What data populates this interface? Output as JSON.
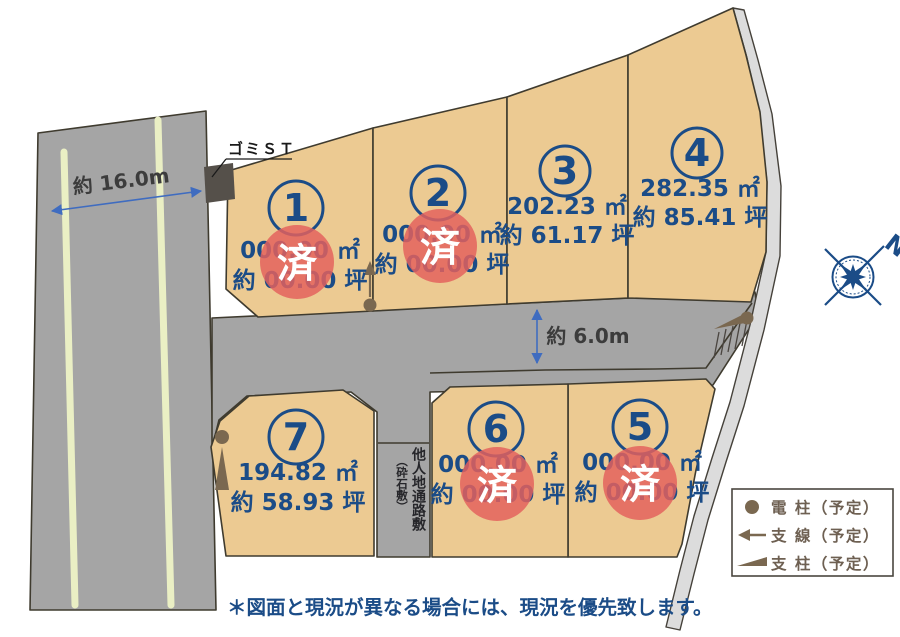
{
  "annotations": {
    "road_left_width": "約 16.0m",
    "road_mid_width": "約 6.0m",
    "garbage_station": "ゴミＳＴ",
    "passage_main": "他人地通路敷",
    "passage_sub": "（砕石敷）",
    "note": "＊図面と現況が異なる場合には、現況を優先致します。",
    "compass": "N",
    "sold": "済"
  },
  "lots": [
    {
      "id": "1",
      "number": "1",
      "area_m2": "000.00 ㎡",
      "area_tsubo": "約 00.00 坪",
      "sold": true
    },
    {
      "id": "2",
      "number": "2",
      "area_m2": "000.00 ㎡",
      "area_tsubo": "約 00.00 坪",
      "sold": true
    },
    {
      "id": "3",
      "number": "3",
      "area_m2": "202.23 ㎡",
      "area_tsubo": "約 61.17 坪",
      "sold": false
    },
    {
      "id": "4",
      "number": "4",
      "area_m2": "282.35 ㎡",
      "area_tsubo": "約 85.41 坪",
      "sold": false
    },
    {
      "id": "5",
      "number": "5",
      "area_m2": "000.00 ㎡",
      "area_tsubo": "約 00.00 坪",
      "sold": true
    },
    {
      "id": "6",
      "number": "6",
      "area_m2": "000.00 ㎡",
      "area_tsubo": "約 00.00 坪",
      "sold": true
    },
    {
      "id": "7",
      "number": "7",
      "area_m2": "194.82 ㎡",
      "area_tsubo": "約 58.93 坪",
      "sold": false
    }
  ],
  "legend": {
    "items": [
      {
        "symbol": "utility-pole",
        "label": "電 柱（予定）"
      },
      {
        "symbol": "guy-wire",
        "label": "支 線（予定）"
      },
      {
        "symbol": "support-strut",
        "label": "支 柱（予定）"
      }
    ]
  },
  "colors": {
    "lot_fill": "#ecca92",
    "road_fill": "#a5a5a5",
    "gravel_path_fill": "#dcdcdc",
    "accent_blue": "#1b4c87",
    "sold_red": "#e4605d",
    "symbol_brown": "#7a6850"
  }
}
